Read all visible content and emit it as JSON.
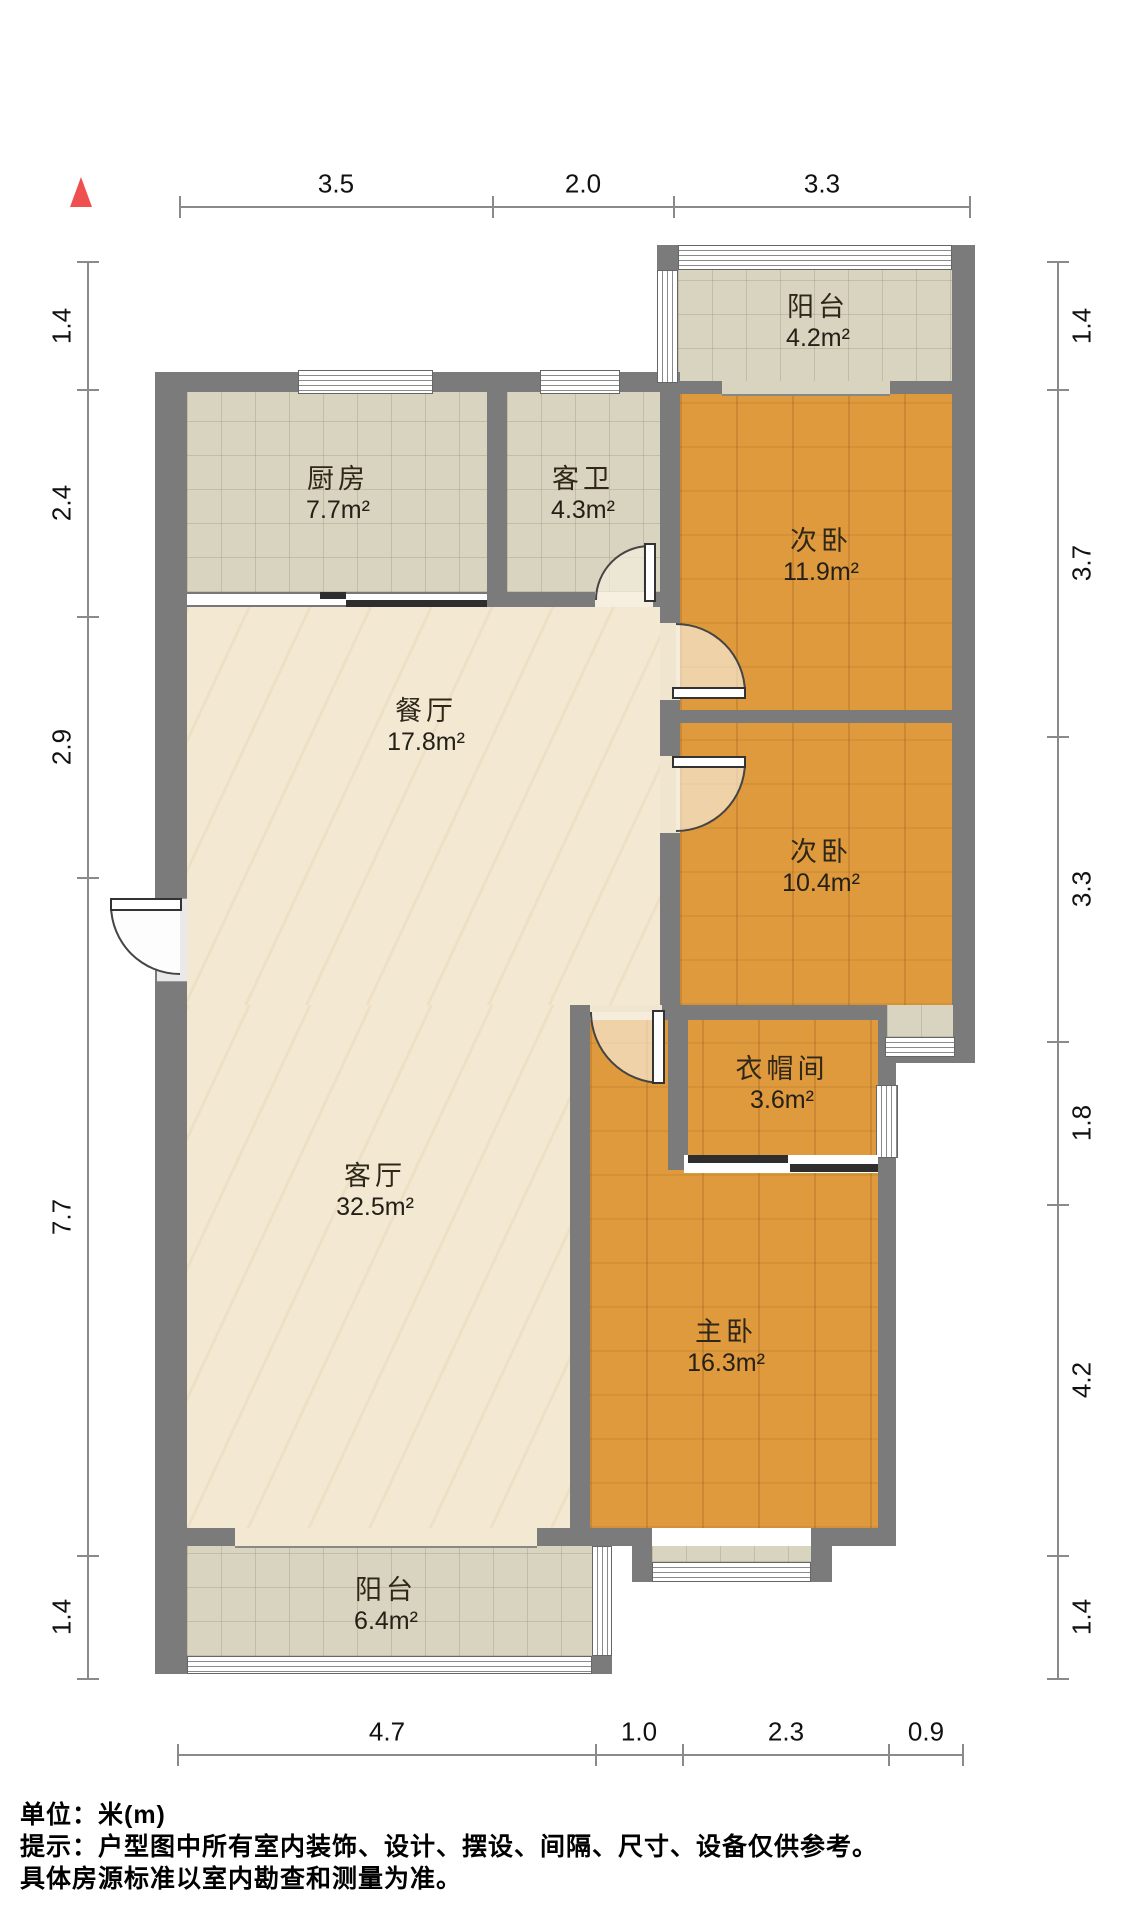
{
  "north_marker": {
    "symbol": "north-arrow"
  },
  "dimensions": {
    "top": [
      {
        "label": "3.5"
      },
      {
        "label": "2.0"
      },
      {
        "label": "3.3"
      }
    ],
    "left": [
      {
        "label": "1.4"
      },
      {
        "label": "2.4"
      },
      {
        "label": "2.9"
      },
      {
        "label": "7.7"
      },
      {
        "label": "1.4"
      }
    ],
    "right": [
      {
        "label": "1.4"
      },
      {
        "label": "3.7"
      },
      {
        "label": "3.3"
      },
      {
        "label": "1.8"
      },
      {
        "label": "4.2"
      },
      {
        "label": "1.4"
      }
    ],
    "bottom": [
      {
        "label": "4.7"
      },
      {
        "label": "1.0"
      },
      {
        "label": "2.3"
      },
      {
        "label": "0.9"
      }
    ]
  },
  "rooms": [
    {
      "id": "balcony-top",
      "name": "阳台",
      "area": "4.2m²"
    },
    {
      "id": "kitchen",
      "name": "厨房",
      "area": "7.7m²"
    },
    {
      "id": "guest-bath",
      "name": "客卫",
      "area": "4.3m²"
    },
    {
      "id": "bedroom-2a",
      "name": "次卧",
      "area": "11.9m²"
    },
    {
      "id": "dining-room",
      "name": "餐厅",
      "area": "17.8m²"
    },
    {
      "id": "bedroom-2b",
      "name": "次卧",
      "area": "10.4m²"
    },
    {
      "id": "cloakroom",
      "name": "衣帽间",
      "area": "3.6m²"
    },
    {
      "id": "living-room",
      "name": "客厅",
      "area": "32.5m²"
    },
    {
      "id": "master-bedroom",
      "name": "主卧",
      "area": "16.3m²"
    },
    {
      "id": "balcony-bottom",
      "name": "阳台",
      "area": "6.4m²"
    }
  ],
  "footer": {
    "line1": "单位：米(m)",
    "line2": "提示：户型图中所有室内装饰、设计、摆设、间隔、尺寸、设备仅供参考。",
    "line3": "具体房源标准以室内勘查和测量为准。"
  },
  "colors": {
    "wall": "#7b7b7b",
    "wood_floor": "#e09a3e",
    "tile_floor": "#d8d4bf",
    "cream_floor": "#f3e9d3",
    "north_arrow": "#ef4f4f"
  }
}
